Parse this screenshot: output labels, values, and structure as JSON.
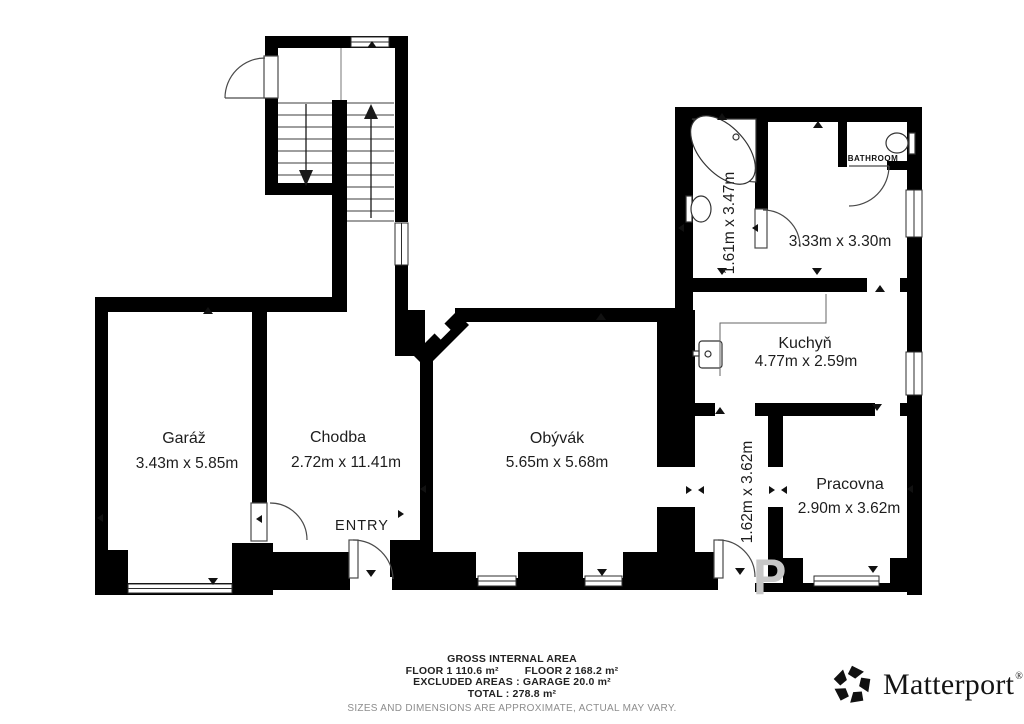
{
  "rooms": {
    "garaz": {
      "name": "Garáž",
      "dims": "3.43m x 5.85m"
    },
    "chodba": {
      "name": "Chodba",
      "dims": "2.72m x 11.41m"
    },
    "obyvak": {
      "name": "Obývák",
      "dims": "5.65m x 5.68m"
    },
    "kuchyn": {
      "name": "Kuchyň",
      "dims": "4.77m x 2.59m"
    },
    "pracovna": {
      "name": "Pracovna",
      "dims": "2.90m x 3.62m"
    },
    "bathroom_large": {
      "dims": "1.61m x 3.47m"
    },
    "room_333": {
      "dims": "3.33m x 3.30m"
    },
    "hall_162": {
      "dims": "1.62m x 3.62m"
    },
    "bathroom_small": {
      "name": "BATHROOM"
    }
  },
  "labels": {
    "entry": "ENTRY",
    "watermark": "P"
  },
  "footer": {
    "title": "GROSS INTERNAL AREA",
    "floor1": "FLOOR 1 110.6 m²",
    "floor2": "FLOOR 2 168.2 m²",
    "excluded": "EXCLUDED AREAS :  GARAGE 20.0 m²",
    "total": "TOTAL :  278.8 m²",
    "disclaimer": "SIZES AND DIMENSIONS ARE APPROXIMATE, ACTUAL MAY VARY."
  },
  "brand": {
    "name": "Matterport",
    "registered": "®"
  },
  "colors": {
    "wall": "#000000",
    "text": "#1d1d1d",
    "muted": "#8d8d8d",
    "watermark": "#c7c7c7"
  }
}
